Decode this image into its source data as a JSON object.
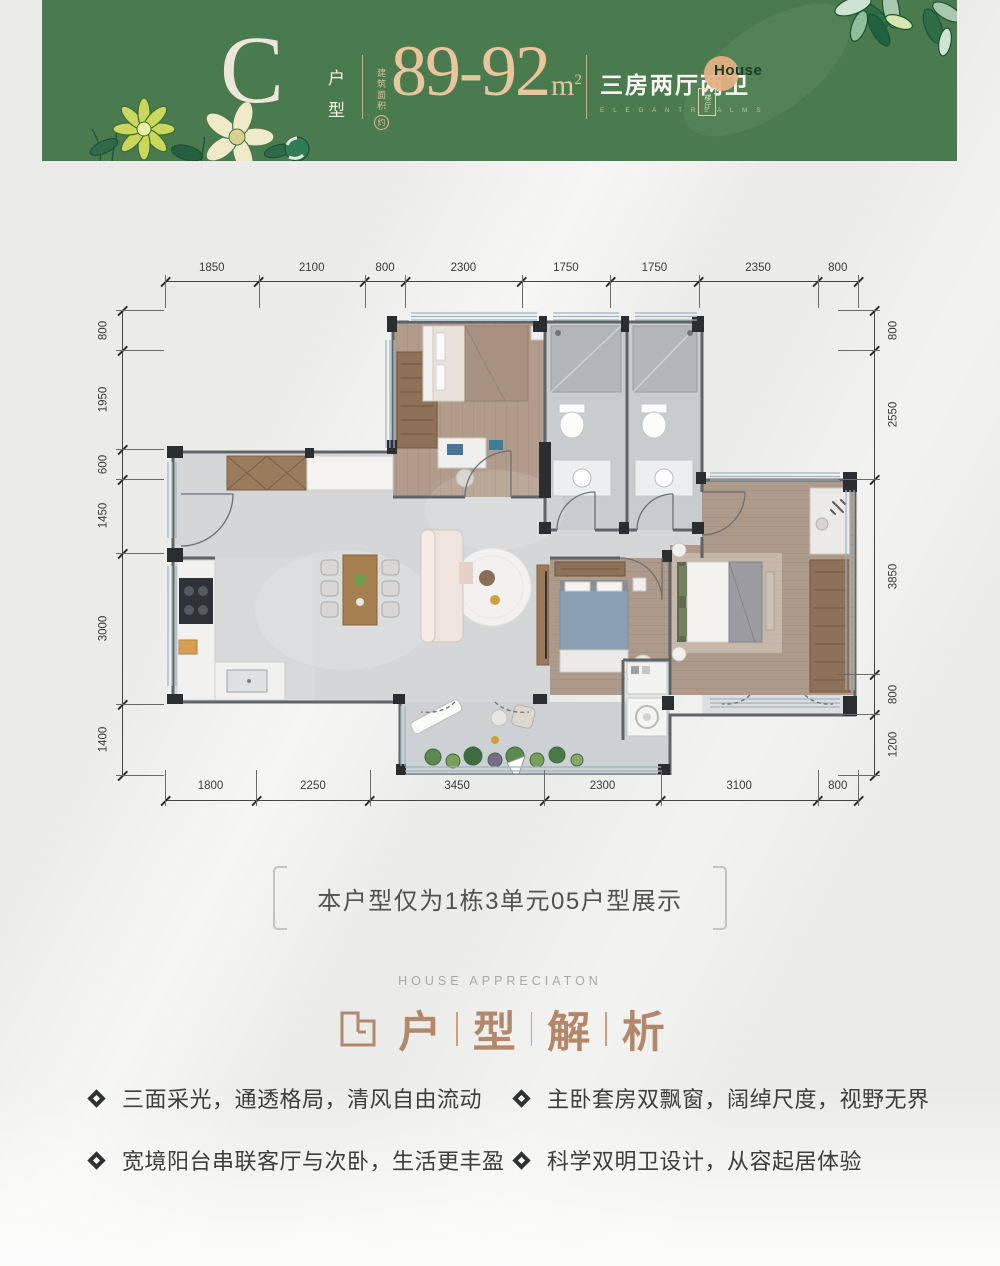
{
  "banner": {
    "bg_color": "#4a7b4e",
    "accent_gold": "#e9c49c",
    "type_letter": "C",
    "type_label": "户型",
    "area_label": "建筑面积",
    "area_circle": "约",
    "area_value": "89-92",
    "area_unit_base": "m",
    "area_unit_exp": "2",
    "rooms_label": "三房两厅两卫",
    "rooms_sub": "E L E G A N T  R E A L M S",
    "badge_text": "House",
    "seal_text": "楼厅"
  },
  "floor_plan": {
    "dims_top": [
      1850,
      2100,
      800,
      2300,
      1750,
      1750,
      2350,
      800
    ],
    "dims_bottom": [
      1800,
      2250,
      3450,
      2300,
      3100,
      800
    ],
    "dims_left": [
      800,
      1950,
      600,
      1450,
      3000,
      1400
    ],
    "dims_right": [
      800,
      2550,
      3850,
      800,
      1200
    ]
  },
  "caption": {
    "text": "本户型仅为1栋3单元05户型展示"
  },
  "section": {
    "eyebrow": "HOUSE APPRECIATON",
    "title_chars": [
      "户",
      "型",
      "解",
      "析"
    ],
    "title_color": "#b3886a"
  },
  "features_left": [
    {
      "text": "三面采光，通透格局，清风自由流动"
    },
    {
      "text": "宽境阳台串联客厅与次卧，生活更丰盈"
    }
  ],
  "features_right": [
    {
      "text": "主卧套房双飘窗，阔绰尺度，视野无界"
    },
    {
      "text": "科学双明卫设计，从容起居体验"
    }
  ]
}
